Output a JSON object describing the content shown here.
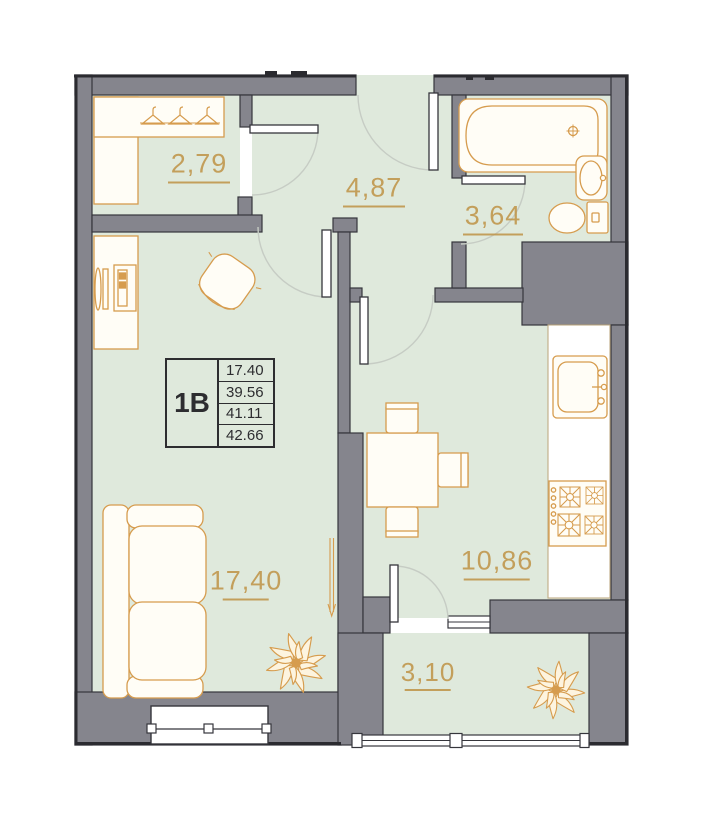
{
  "title": "Apartment floor plan, unit 1B",
  "unit_card": {
    "unit_label": "1B",
    "area_values": [
      "17.40",
      "39.56",
      "41.11",
      "42.66"
    ]
  },
  "rooms": {
    "wardrobe": {
      "area_label": "2,79"
    },
    "hallway": {
      "area_label": "4,87"
    },
    "bathroom": {
      "area_label": "3,64"
    },
    "living_room": {
      "area_label": "17,40"
    },
    "kitchen": {
      "area_label": "10,86"
    },
    "balcony": {
      "area_label": "3,10"
    }
  },
  "colors": {
    "floor_green": "#dfe9dc",
    "wall_gray": "#85858d",
    "outline_dark": "#36363c",
    "furniture_accent": "#d69c4e",
    "label_text": "#c0954a",
    "card_text": "#2d2d30"
  },
  "fixtures": [
    "wardrobe-hangers",
    "desk-with-computer",
    "office-chair",
    "sofa",
    "radiator",
    "plant",
    "dining-table",
    "dining-chairs",
    "kitchen-counter",
    "kitchen-sink",
    "stove",
    "bathtub",
    "washbasin",
    "toilet",
    "entrance-door",
    "interior-doors",
    "windows",
    "balcony-glazing"
  ]
}
